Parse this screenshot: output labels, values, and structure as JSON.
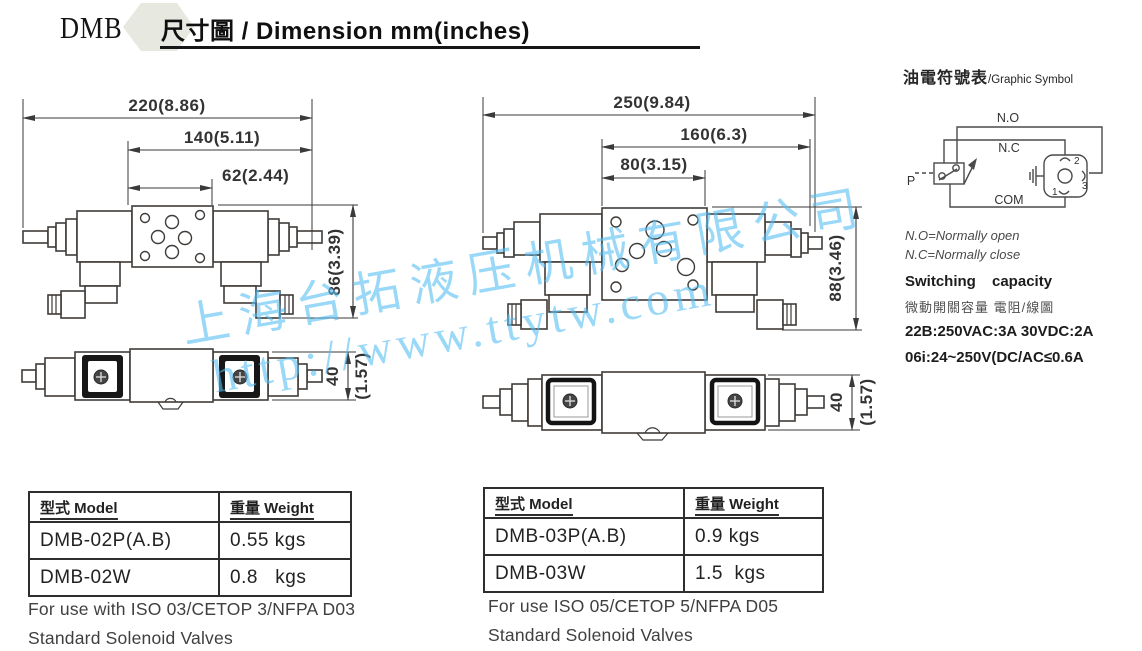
{
  "header": {
    "brand": "DMB",
    "title": "尺寸圖 / Dimension mm(inches)"
  },
  "watermark": {
    "company": "上海台拓液压机械有限公司",
    "url": "http://www.ttytw.com"
  },
  "graphic_symbol": {
    "title_cjk": "油電符號表",
    "title_en": "/Graphic Symbol",
    "labels": {
      "no": "N.O",
      "nc": "N.C",
      "p": "P",
      "com": "COM",
      "pin1": "1",
      "pin2": "2",
      "pin3": "3"
    },
    "note_no": "N.O=Normally open",
    "note_nc": "N.C=Normally close",
    "switching_heading": "Switching capacity",
    "switching_cjk": "微動開關容量 電阻/線圖",
    "rating_line1": "22B:250VAC:3A  30VDC:2A",
    "rating_line2": "06i:24~250V(DC/AC≤0.6A"
  },
  "drawing_left": {
    "dims": {
      "overall": "220(8.86)",
      "mid": "140(5.11)",
      "small": "62(2.44)",
      "height": "86(3.39)",
      "side_height_mm": "40",
      "side_height_in": "(1.57)"
    }
  },
  "drawing_right": {
    "dims": {
      "overall": "250(9.84)",
      "mid": "160(6.3)",
      "small": "80(3.15)",
      "height": "88(3.46)",
      "side_height_mm": "40",
      "side_height_in": "(1.57)"
    }
  },
  "table_left": {
    "headers": [
      "型式 Model",
      "重量 Weight"
    ],
    "rows": [
      [
        "DMB-02P(A.B)",
        "0.55 kgs"
      ],
      [
        "DMB-02W",
        "0.8   kgs"
      ]
    ],
    "caption_line1": "For use with ISO 03/CETOP 3/NFPA D03",
    "caption_line2": "Standard Solenoid Valves"
  },
  "table_right": {
    "headers": [
      "型式 Model",
      "重量 Weight"
    ],
    "rows": [
      [
        "DMB-03P(A.B)",
        "0.9 kgs"
      ],
      [
        "DMB-03W",
        "1.5  kgs"
      ]
    ],
    "caption_line1": "For use  ISO 05/CETOP 5/NFPA D05",
    "caption_line2": "Standard Solenoid Valves"
  }
}
